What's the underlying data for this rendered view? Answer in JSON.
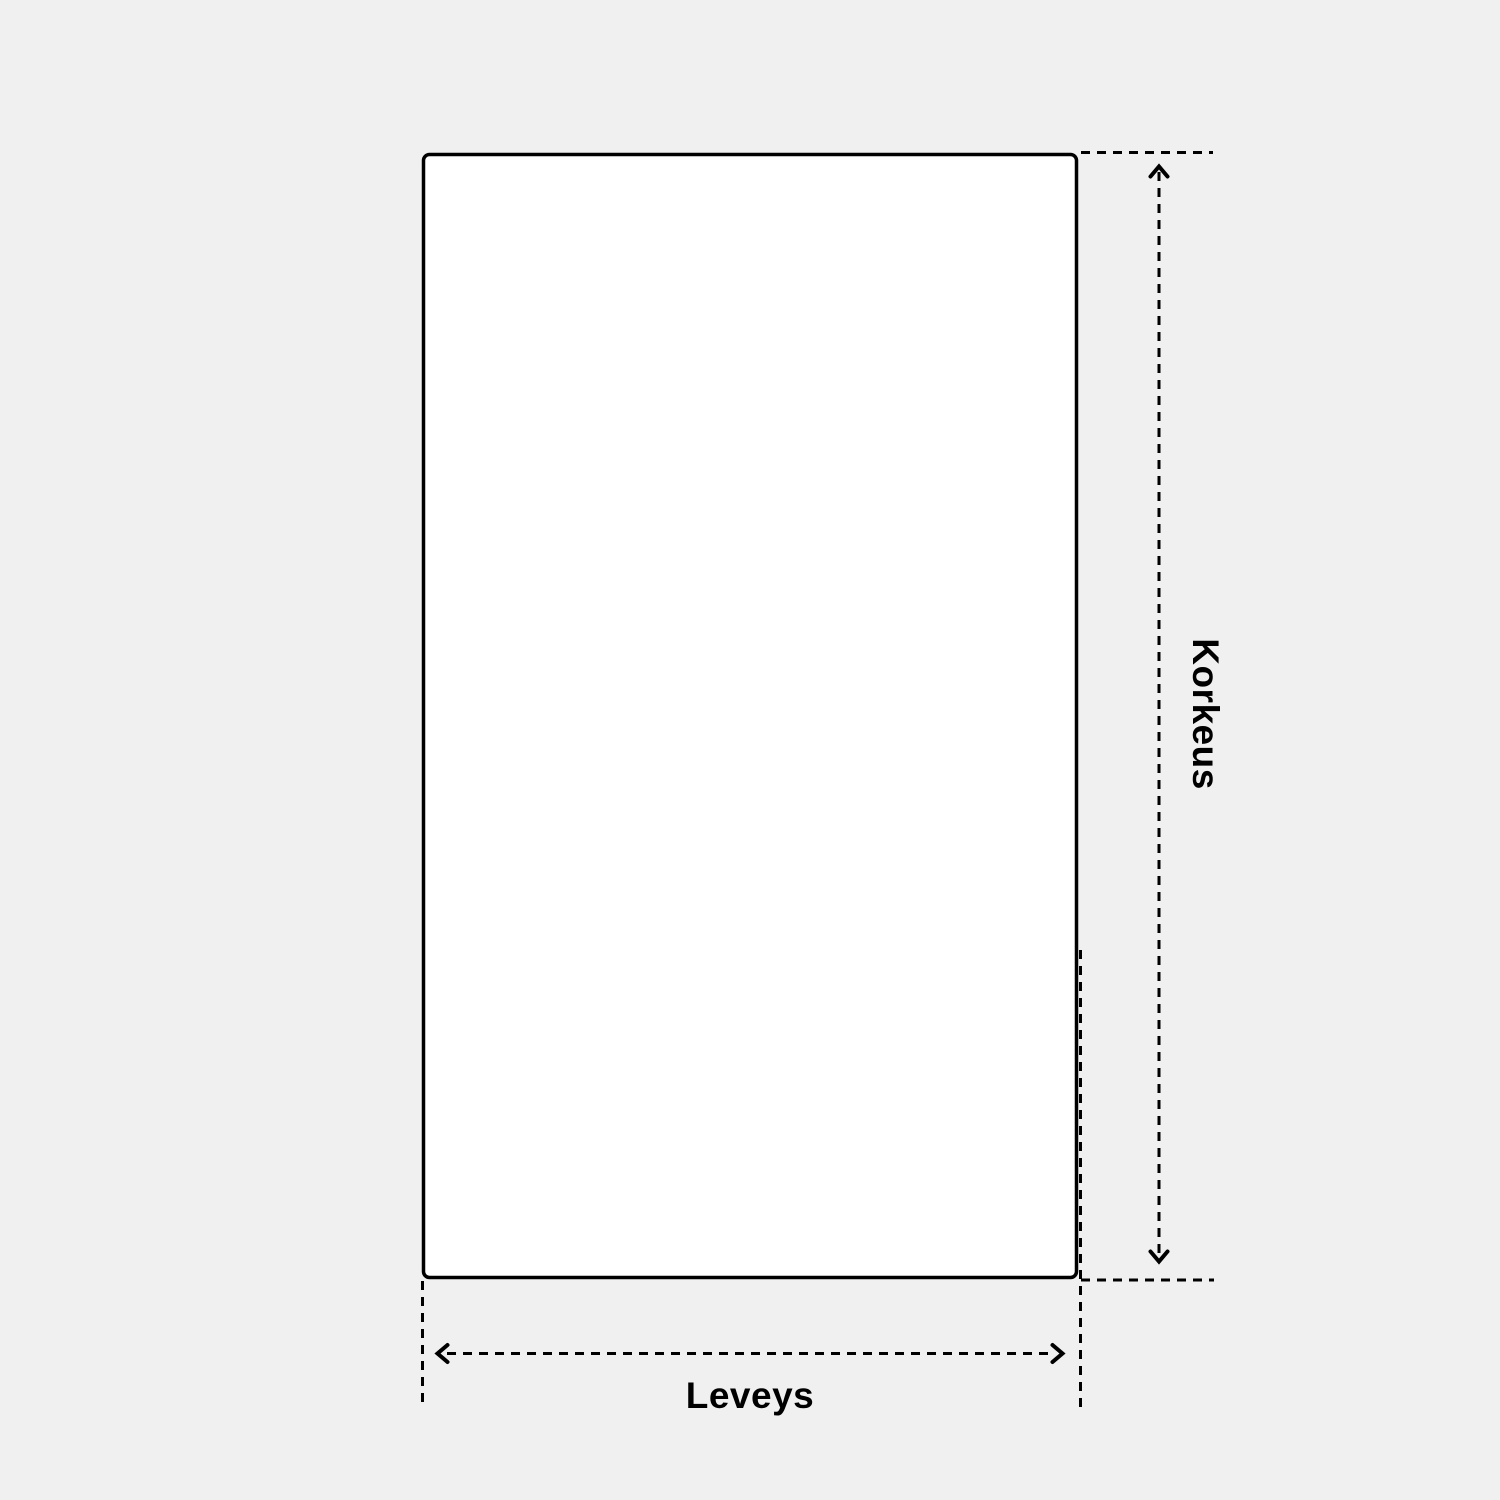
{
  "diagram": {
    "type": "product-dimension-diagram",
    "shape": "rectangle",
    "height_label": "Korkeus",
    "width_label": "Leveys"
  },
  "icons": {
    "height_dimension": "up-down-dashed-arrow",
    "width_dimension": "left-right-dashed-arrow"
  },
  "colors": {
    "background": "#f0f0f0",
    "shape_fill": "#ffffff",
    "line": "#000000",
    "text": "#000000"
  }
}
